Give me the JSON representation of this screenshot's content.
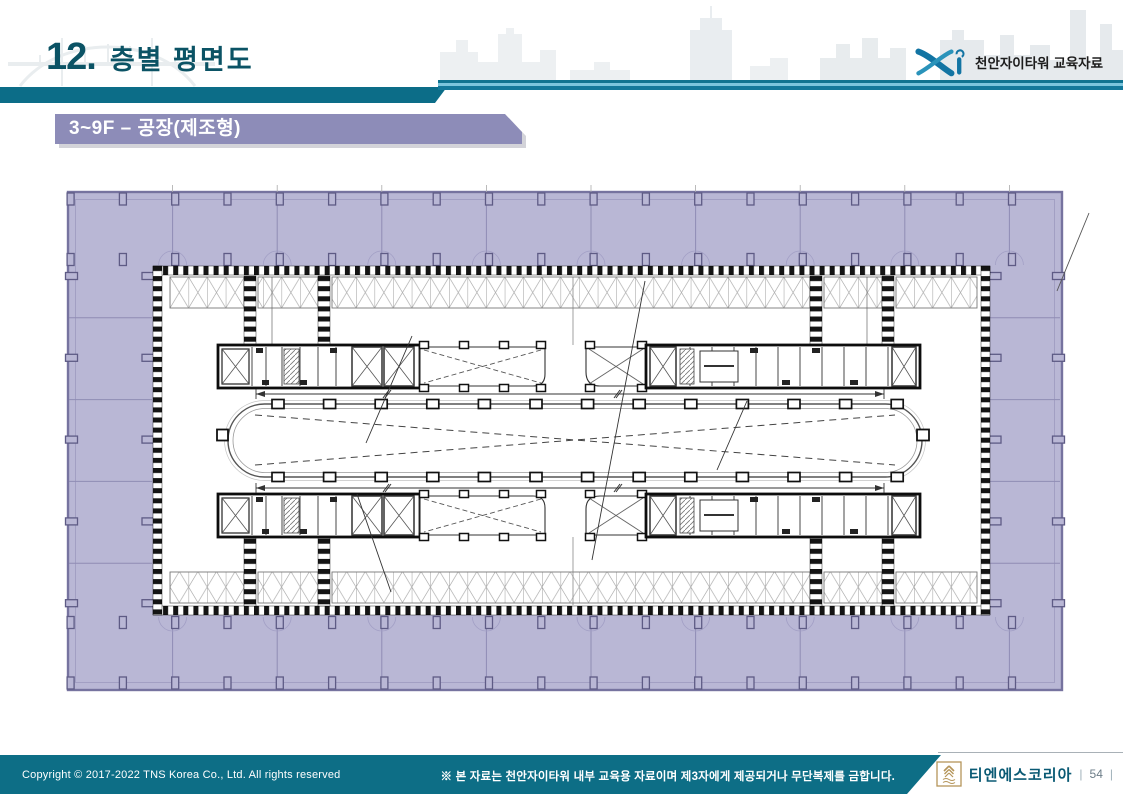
{
  "header": {
    "slide_number": "12.",
    "title": "층별 평면도",
    "brand_text": "천안자이타워 교육자료"
  },
  "section": {
    "label": "3~9F – 공장(제조형)"
  },
  "plan": {
    "description": "3~9F 공장(제조형) 평면도 도면"
  },
  "footer": {
    "copyright": "Copyright © 2017-2022 TNS Korea Co., Ltd.  All rights reserved",
    "notice": "※ 본 자료는 천안자이타워 내부 교육용 자료이며 제3자에게 제공되거나 무단복제를 금합니다.",
    "company": "티엔에스코리아",
    "page_number": "54",
    "page_separator": "|"
  },
  "colors": {
    "title_text": "#0b5365",
    "accent_teal_dark": "#0c6d88",
    "banner_purple": "#8d8cb8",
    "footer_teal": "#0d6e86",
    "gold": "#b5955a",
    "plan_purple": "#b9b7d5",
    "plan_purple_line": "#76739f",
    "plan_purple_dark": "#8f8cb4",
    "plan_column_edge": "#5e5b85",
    "ink": "#141414"
  }
}
